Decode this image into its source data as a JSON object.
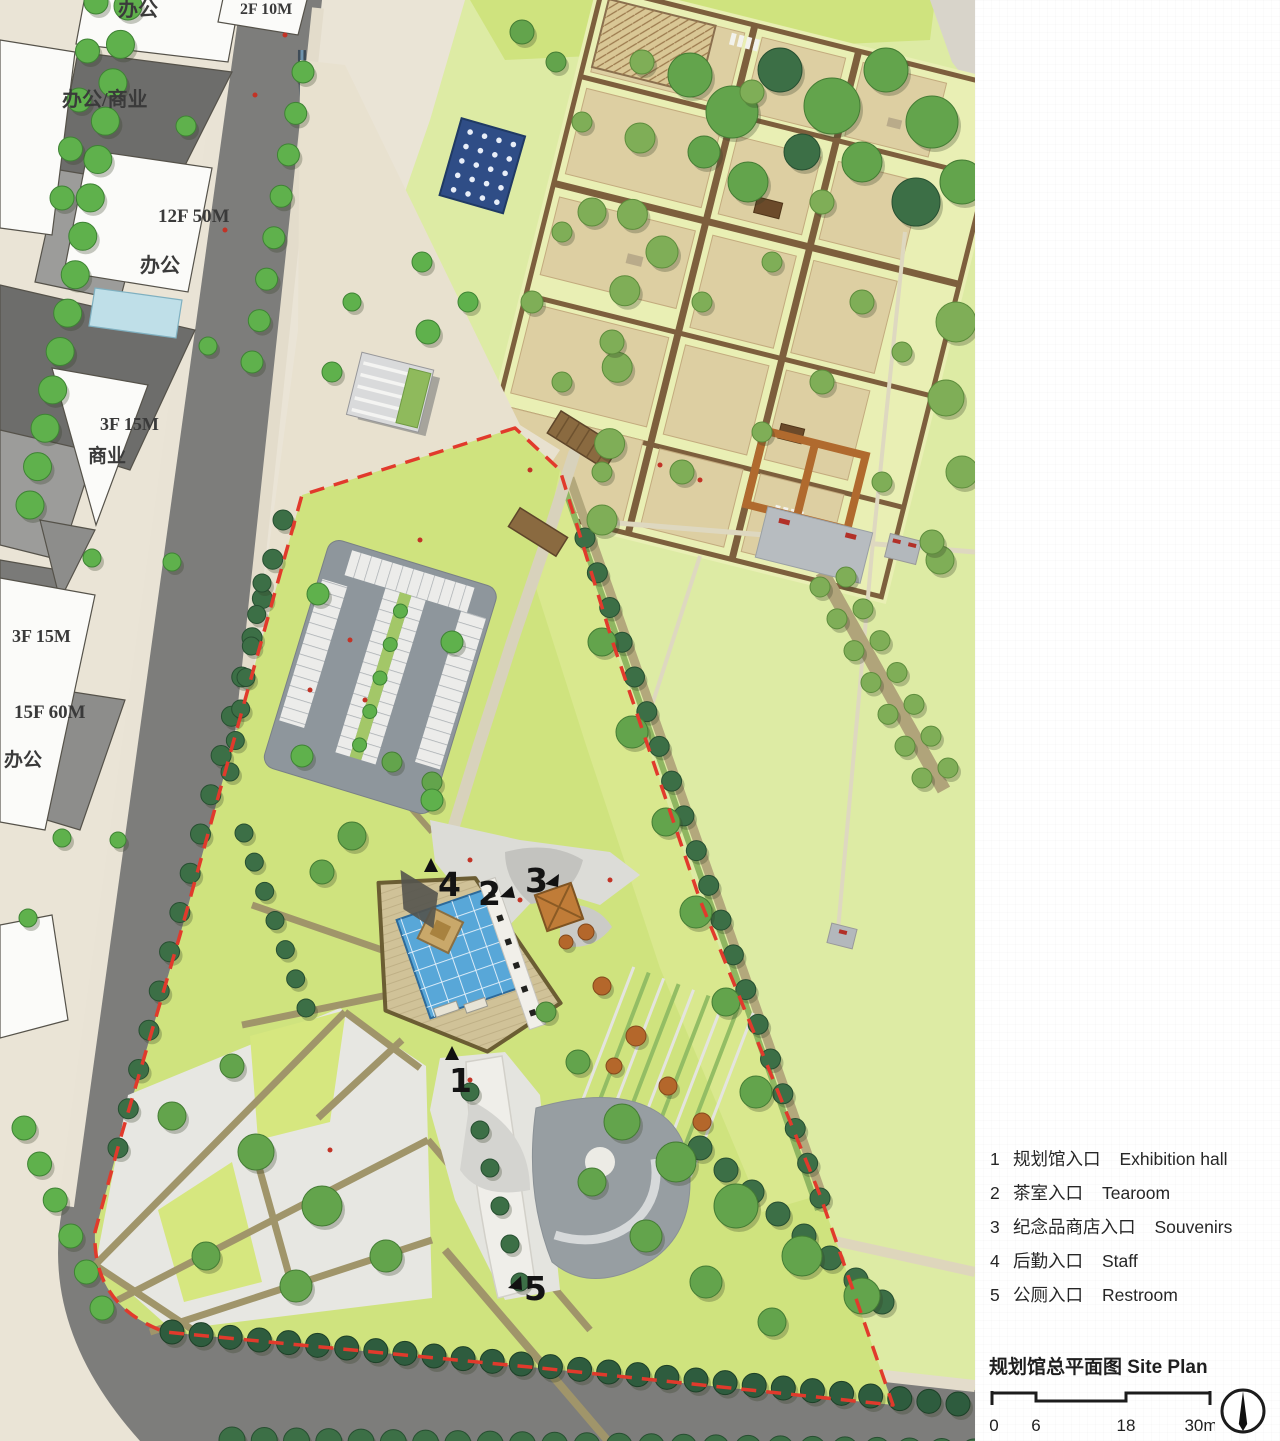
{
  "plan": {
    "labels": [
      {
        "text": "办公"
      },
      {
        "text": "2F 10M"
      },
      {
        "text": "办公/商业"
      },
      {
        "text": "12F 50M"
      },
      {
        "text": "办公"
      },
      {
        "text": "3F 15M"
      },
      {
        "text": "商业"
      },
      {
        "text": "3F 15M"
      },
      {
        "text": "15F 60M"
      },
      {
        "text": "办公"
      }
    ],
    "markers": [
      "1",
      "2",
      "3",
      "4",
      "5"
    ]
  },
  "legend": {
    "items": [
      {
        "num": "1",
        "zh": "规划馆入口",
        "en": "Exhibition hall"
      },
      {
        "num": "2",
        "zh": "茶室入口",
        "en": "Tearoom"
      },
      {
        "num": "3",
        "zh": "纪念品商店入口",
        "en": "Souvenirs"
      },
      {
        "num": "4",
        "zh": "后勤入口",
        "en": "Staff"
      },
      {
        "num": "5",
        "zh": "公厕入口",
        "en": "Restroom"
      }
    ]
  },
  "footer": {
    "title_zh": "规划馆总平面图",
    "title_en": "Site Plan",
    "scale_labels": [
      "0",
      "6",
      "18",
      "30m"
    ]
  },
  "colors": {
    "boundary_red": "#e13a2c",
    "glass_roof_blue": "#58a7d8",
    "site_lawn": "#cfe37e",
    "road_gray": "#7d7d7b",
    "tree_green": "#5fb14c",
    "path_tan": "#a0956a",
    "garden_plot": "#ddcfa2"
  }
}
